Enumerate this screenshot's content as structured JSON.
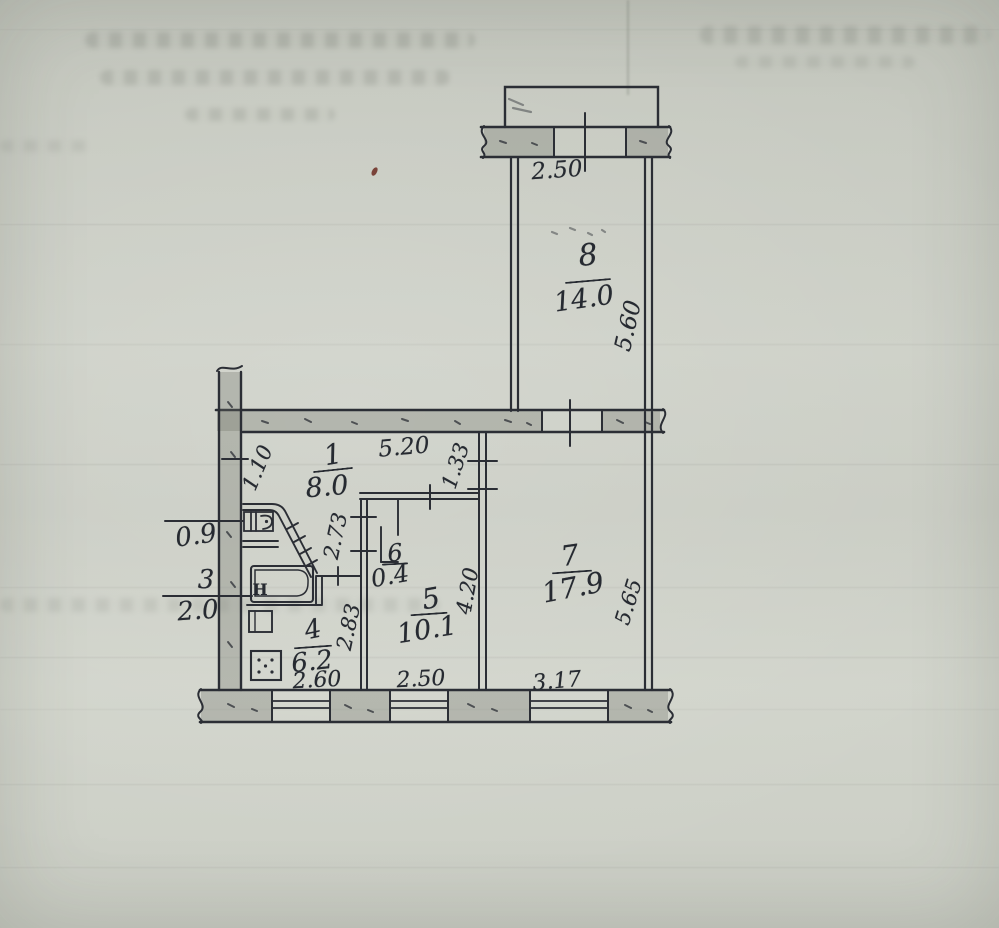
{
  "sheet": {
    "kind": "hand-drawn apartment floor plan on creased paper"
  },
  "rooms": [
    {
      "number": "8",
      "area": "14.0"
    },
    {
      "number": "1",
      "area": "8.0"
    },
    {
      "number": "3",
      "area": "2.0"
    },
    {
      "number": "4",
      "area": "6.2"
    },
    {
      "number": "5",
      "area": "10.1"
    },
    {
      "number": "6",
      "area": "0.4"
    },
    {
      "number": "7",
      "area": "17.9"
    }
  ],
  "dimensions": {
    "balcony_width": "2.50",
    "balcony_depth": "5.60",
    "hallway_width": "5.20",
    "entry_side": "1.10",
    "niche_depth": "1.33",
    "corridor_depth": "2.73",
    "bath_width": "0.9",
    "kitchen_side": "2.83",
    "kitchen_width": "2.60",
    "room5_width": "2.50",
    "room5_depth": "4.20",
    "room7_width": "3.17",
    "room7_depth": "5.65"
  },
  "fixtures": {
    "bath_faucet_mark": "H"
  }
}
